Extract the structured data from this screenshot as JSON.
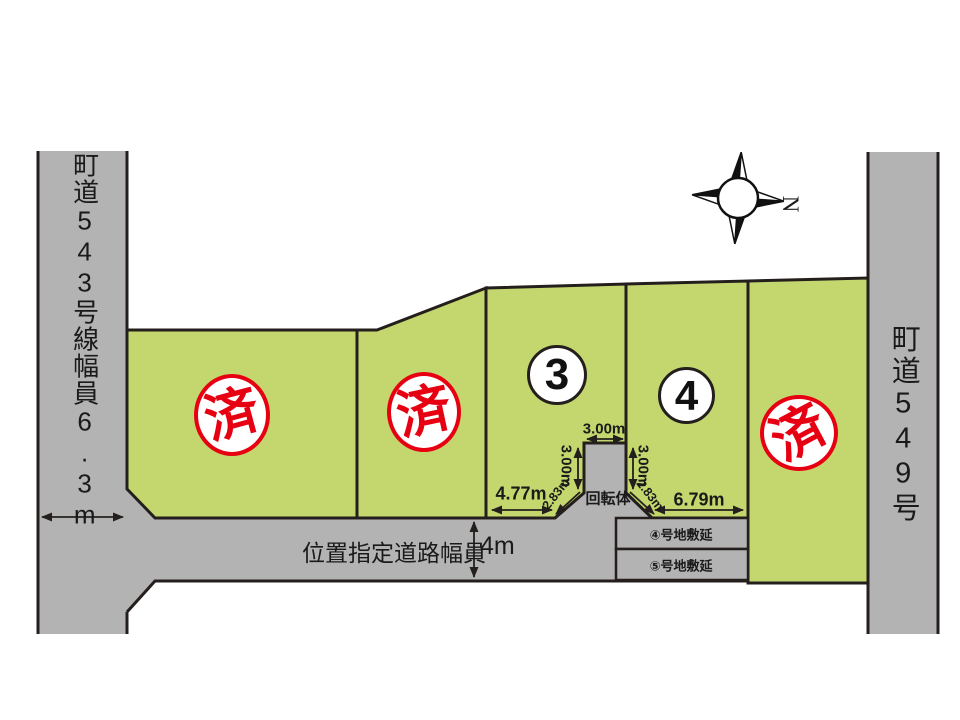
{
  "page": {
    "background": "#ffffff"
  },
  "colors": {
    "lot_green": "#c4d76e",
    "road_gray": "#b3b3b3",
    "outline": "#241f1c",
    "stamp_red": "#e60012"
  },
  "roads": {
    "left_vertical": {
      "label": "町道543号線幅員6.3m"
    },
    "right_vertical": {
      "label": "町道549号"
    },
    "access": {
      "label": "位置指定道路幅員",
      "width": "4m"
    }
  },
  "lots": [
    {
      "name": "lot-1",
      "mark": "済"
    },
    {
      "name": "lot-2",
      "mark": "済"
    },
    {
      "name": "lot-3",
      "number": "3"
    },
    {
      "name": "lot-4",
      "number": "4"
    },
    {
      "name": "lot-5",
      "mark": "済"
    }
  ],
  "turning_area": {
    "label": "回転体",
    "top_width": "3.00m",
    "left_depth": "3.00m",
    "right_depth": "3.00m",
    "left_diagonal": "2.83m",
    "right_diagonal": "2.83m"
  },
  "frontage": {
    "lot3": "4.77m",
    "lot4": "6.79m"
  },
  "extensions": {
    "lot4": "④号地敷延",
    "lot5": "⑤号地敷延"
  },
  "compass": {
    "north": "N"
  }
}
